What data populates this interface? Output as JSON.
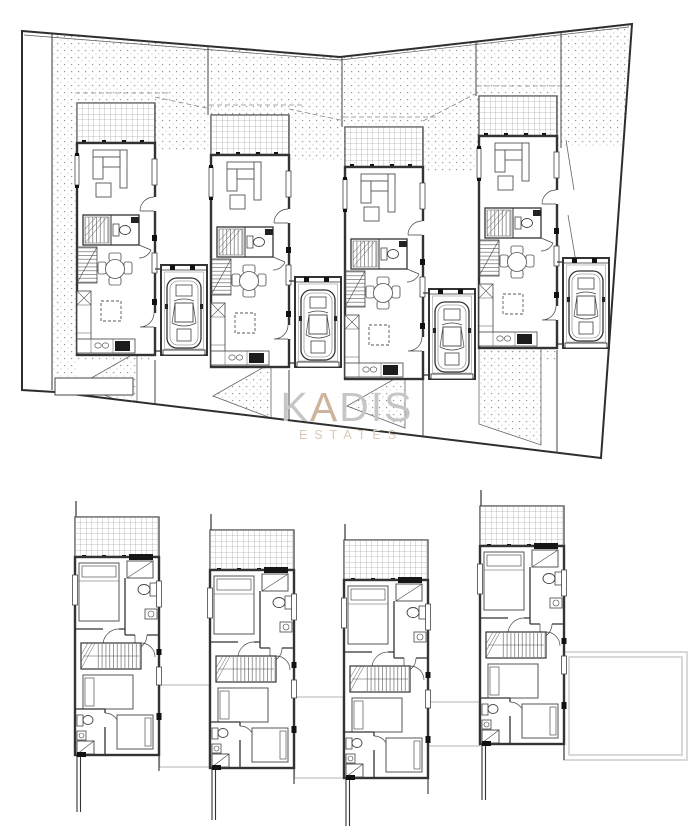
{
  "watermark": {
    "brand_part1": "K",
    "brand_part2": "A",
    "brand_part3": "DIS",
    "subtitle": "ESTATES",
    "brand_color": "#c6c6c6",
    "accent_color": "#cdb49c",
    "subtitle_color": "#d9c8b6"
  },
  "drawing": {
    "ink_color": "#333333",
    "hatch_dot_color": "#9a9a9a",
    "veranda_grid_color": "#8a8a8a",
    "roof_outline_color": "#c9c9c9",
    "plans": [
      {
        "id": "ground-floor-site-plan",
        "units": 4,
        "unit_features": [
          "veranda",
          "sofa",
          "coffee-table",
          "staircase",
          "wc",
          "dining-table",
          "kitchen-counter",
          "kitchen-island",
          "garage",
          "car",
          "driveway"
        ]
      },
      {
        "id": "first-floor-plan",
        "units": 4,
        "unit_features": [
          "roof-terrace",
          "bed",
          "wardrobe",
          "toilet",
          "sink",
          "staircase",
          "shower",
          "roof-outline"
        ]
      }
    ]
  }
}
